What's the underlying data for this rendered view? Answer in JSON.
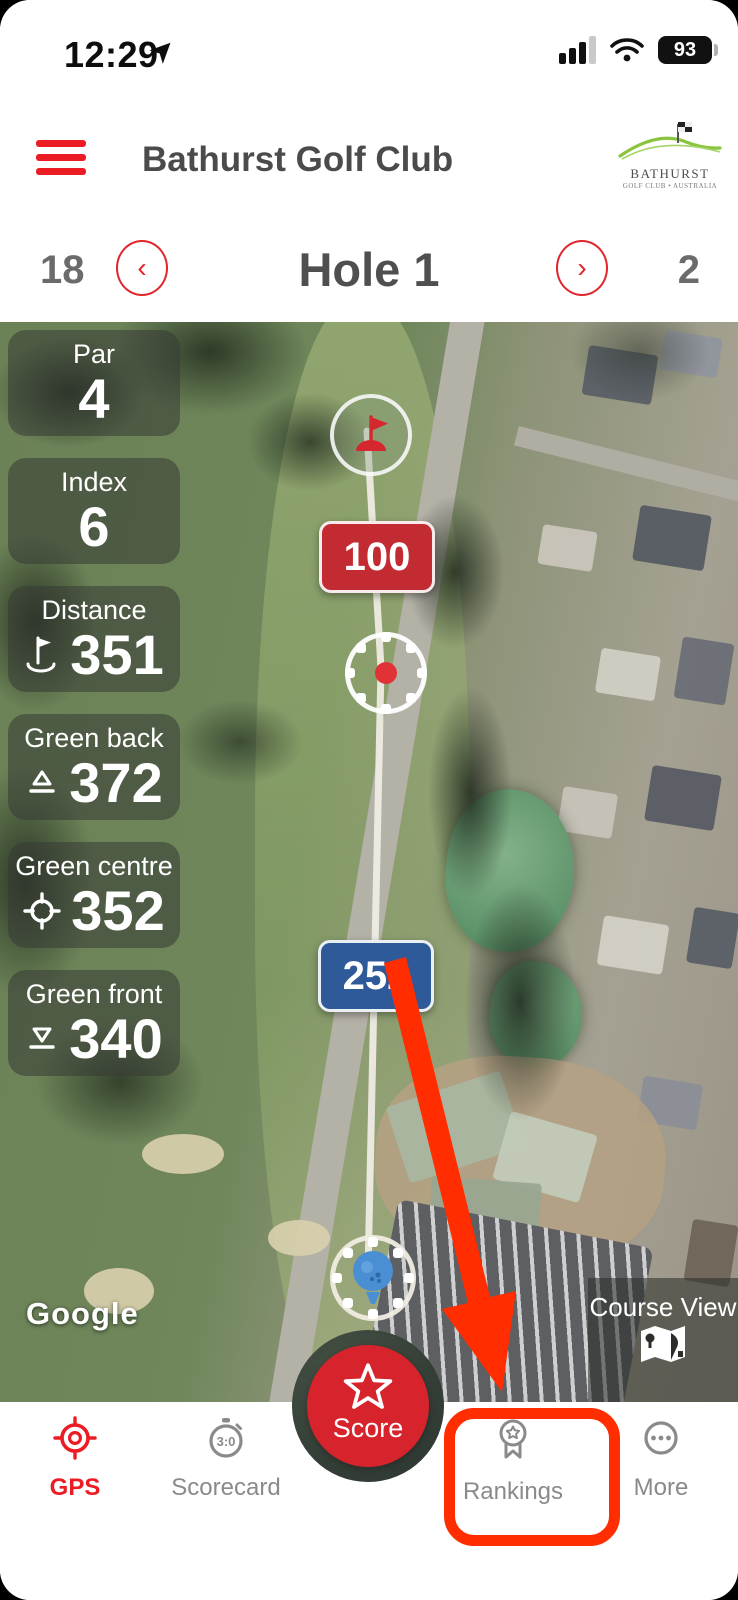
{
  "status_bar": {
    "time": "12:29",
    "battery_percent": "93"
  },
  "header": {
    "title": "Bathurst Golf Club",
    "logo_line1": "BATHURST",
    "logo_line2": "GOLF CLUB • AUSTRALIA"
  },
  "hole_nav": {
    "prev_number": "18",
    "title": "Hole 1",
    "next_number": "2"
  },
  "map": {
    "stats": [
      {
        "label": "Par",
        "value": "4"
      },
      {
        "label": "Index",
        "value": "6"
      },
      {
        "label": "Distance",
        "value": "351",
        "icon": "flag-hole-icon"
      },
      {
        "label": "Green back",
        "value": "372",
        "icon": "green-back-icon"
      },
      {
        "label": "Green centre",
        "value": "352",
        "icon": "green-centre-icon"
      },
      {
        "label": "Green front",
        "value": "340",
        "icon": "green-front-icon"
      }
    ],
    "target_distance_badge": "100",
    "tee_distance_badge": "252",
    "google_label": "Google",
    "course_view_label": "Course View"
  },
  "score_button": {
    "label": "Score"
  },
  "bottom_nav": {
    "items": [
      {
        "label": "GPS",
        "active": true
      },
      {
        "label": "Scorecard",
        "active": false,
        "stopwatch_text": "3:0"
      },
      {
        "label": "Rankings",
        "active": false,
        "annotated": true
      },
      {
        "label": "More",
        "active": false
      }
    ]
  },
  "colors": {
    "accent_red": "#e2242b",
    "annotation_red": "#ff2d00",
    "badge_red": "#c32b33",
    "badge_blue": "#2e5a99",
    "nav_inactive": "#8a8a8a"
  }
}
